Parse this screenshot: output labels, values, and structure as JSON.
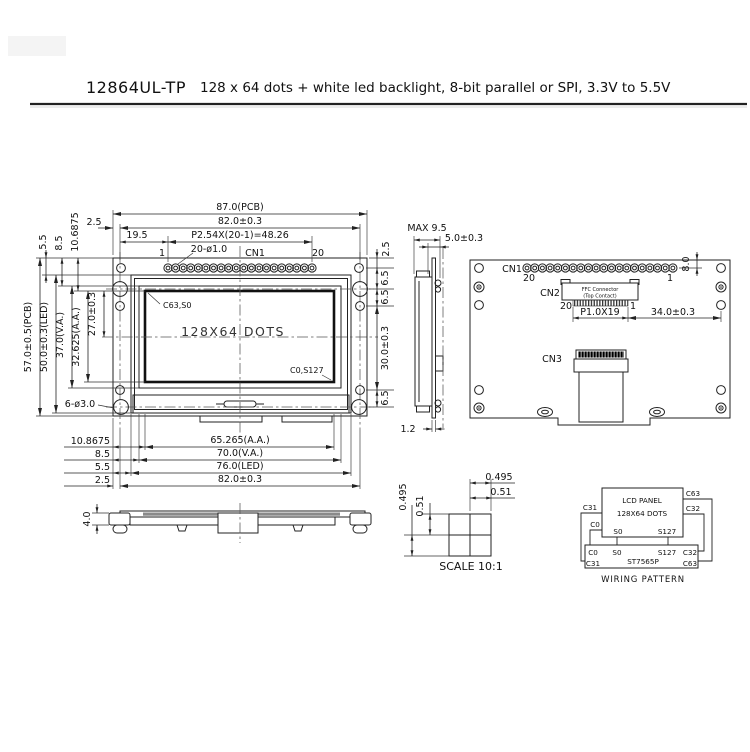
{
  "header": {
    "model": "12864UL-TP",
    "description": "128 x 64 dots + white led backlight, 8-bit parallel or SPI, 3.3V to 5.5V"
  },
  "front": {
    "d_pcb_w": "87.0(PCB)",
    "d_w82": "82.0±0.3",
    "d_25_left": "2.5",
    "d_pitch": "P2.54X(20-1)=48.26",
    "d_195": "19.5",
    "pin1": "1",
    "pin20": "20",
    "cn1": "CN1",
    "holes20": "20-ø1.0",
    "d_25_right": "2.5",
    "d_55_top": "5.5",
    "d_85_top": "8.5",
    "d_106875": "10.6875",
    "d_pcb_h": "57.0±0.5(PCB)",
    "d_led_h": "50.0±0.3(LED)",
    "d_va_h": "37.0(V.A.)",
    "d_aa_h": "32.625(A.A.)",
    "d_27": "27.0±0.3",
    "holes6": "6-ø3.0",
    "d_65a": "6.5",
    "d_65b": "6.5",
    "d_30": "30.0±0.3",
    "d_65c": "6.5",
    "d_108675": "10.8675",
    "d_85_bot": "8.5",
    "d_55_bot": "5.5",
    "d_25_bot": "2.5",
    "d_aa_w": "65.265(A.A.)",
    "d_va_w": "70.0(V.A.)",
    "d_led_w": "76.0(LED)",
    "d_pcb_w2": "82.0±0.3",
    "display": "128X64 DOTS",
    "corner_tl": "C63,S0",
    "corner_br": "C0,S127"
  },
  "side": {
    "max": "MAX 9.5",
    "d_50": "5.0±0.3",
    "d_12": "1.2"
  },
  "back": {
    "cn1": "CN1",
    "p20": "20",
    "p1": "1",
    "d_80": "8.0",
    "cn2": "CN2",
    "ffc_line1": "FFC Connector",
    "ffc_line2": "(Top Contact)",
    "p20b": "20",
    "p1b": "1",
    "d_pitch": "P1.0X19",
    "d_34": "34.0±0.3",
    "cn3": "CN3"
  },
  "bottom": {
    "d_40": "4.0"
  },
  "dot": {
    "w_dot": "0.495",
    "w_pitch": "0.51",
    "h_dot": "0.495",
    "h_pitch": "0.51",
    "scale": "SCALE 10:1"
  },
  "wiring": {
    "panel1": "LCD PANEL",
    "panel2": "128X64 DOTS",
    "s0t": "S0",
    "s127t": "S127",
    "c31t": "C31",
    "c0t": "C0",
    "c63t": "C63",
    "c32t": "C32",
    "c0b": "C0",
    "s0b": "S0",
    "s127b": "S127",
    "c32b": "C32",
    "c31b": "C31",
    "ic": "ST7565P",
    "c63b": "C63",
    "caption": "WIRING PATTERN"
  }
}
